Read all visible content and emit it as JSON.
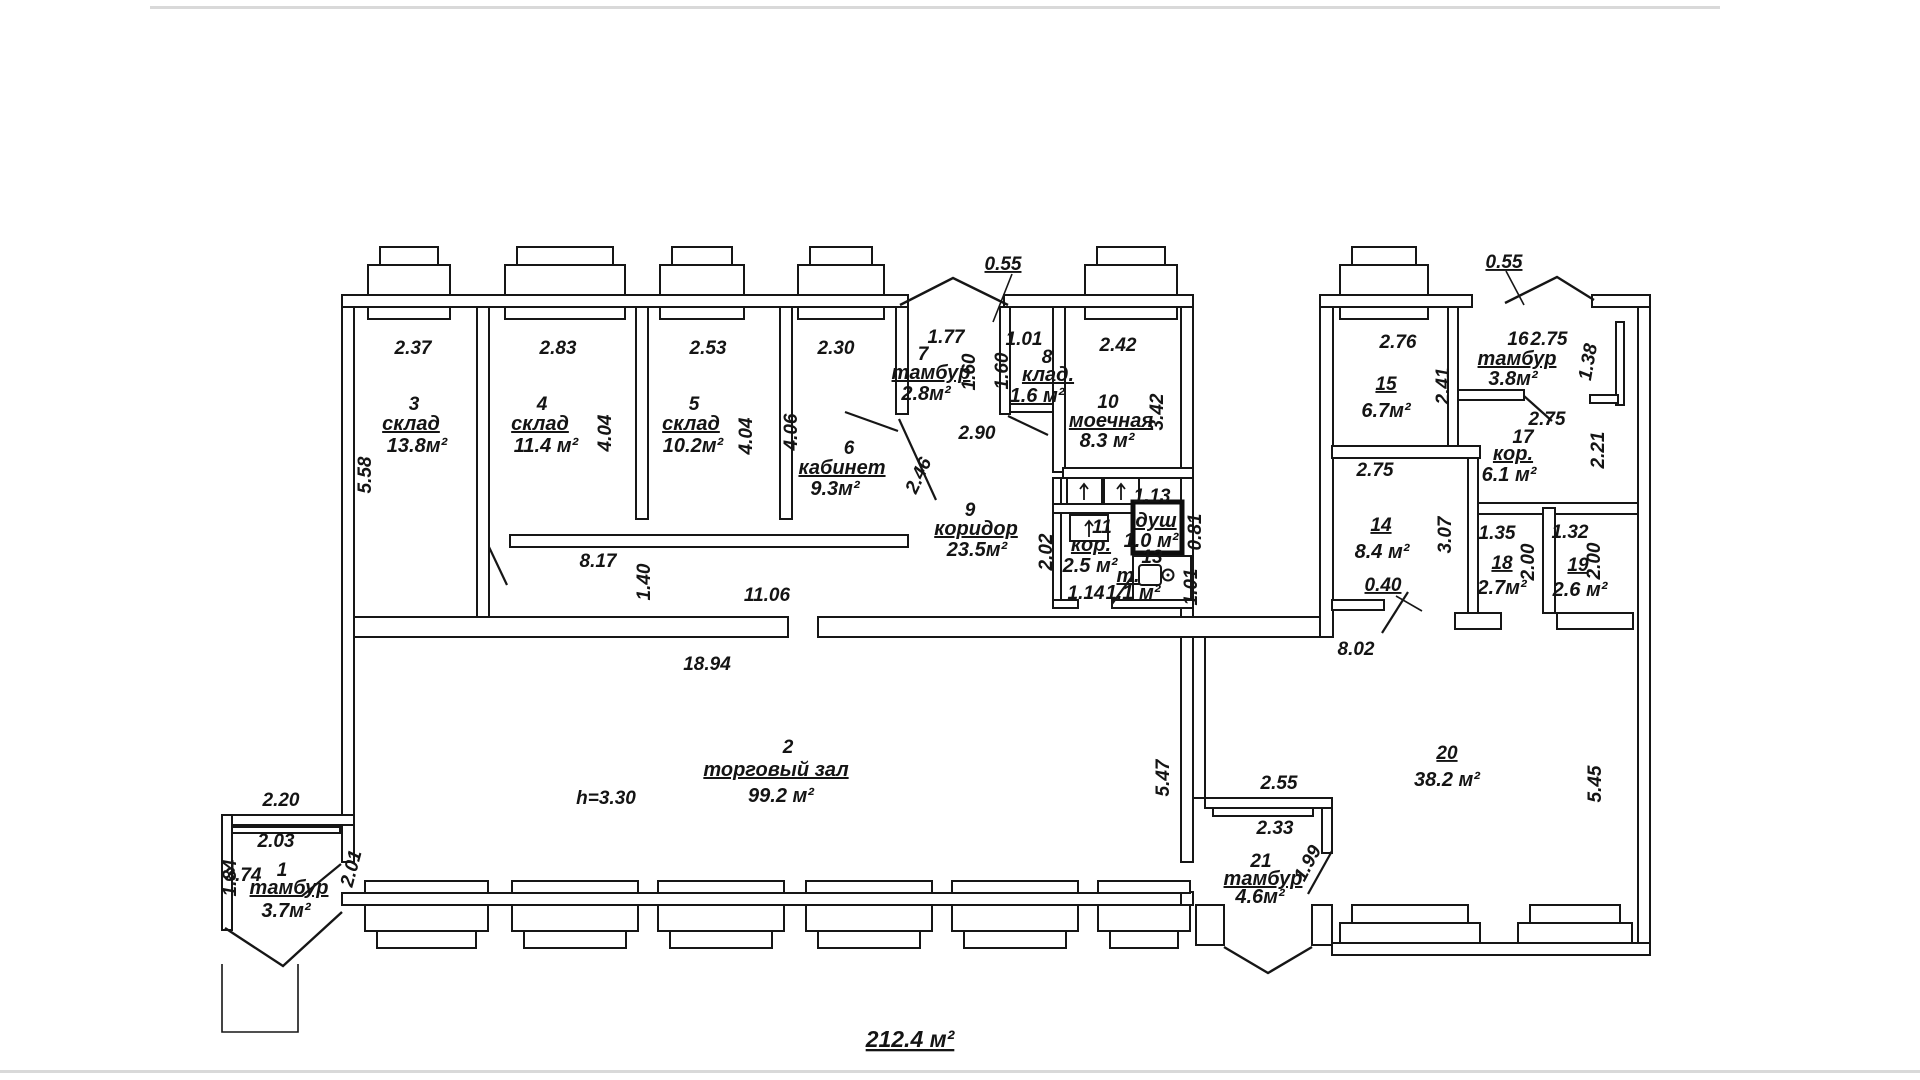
{
  "total_area_label": "212.4 м²",
  "rooms": [
    {
      "num": "1",
      "name": "тамбур",
      "area": "3.7м²"
    },
    {
      "num": "2",
      "name": "торговый зал",
      "area": "99.2 м²"
    },
    {
      "num": "3",
      "name": "склад",
      "area": "13.8м²"
    },
    {
      "num": "4",
      "name": "склад",
      "area": "11.4 м²"
    },
    {
      "num": "5",
      "name": "склад",
      "area": "10.2м²"
    },
    {
      "num": "6",
      "name": "кабинет",
      "area": "9.3м²"
    },
    {
      "num": "7",
      "name": "тамбур",
      "area": "2.8м²"
    },
    {
      "num": "8",
      "name": "клад.",
      "area": "1.6 м²"
    },
    {
      "num": "9",
      "name": "коридор",
      "area": "23.5м²"
    },
    {
      "num": "10",
      "name": "моечная",
      "area": "8.3 м²"
    },
    {
      "num": "11",
      "name": "кор.",
      "area": "2.5 м²"
    },
    {
      "num": "",
      "name": "душ",
      "area": "1.0 м²"
    },
    {
      "num": "13",
      "name": "т.",
      "area": "1.1 м²"
    },
    {
      "num": "14",
      "name": "",
      "area": "8.4 м²"
    },
    {
      "num": "15",
      "name": "",
      "area": "6.7м²"
    },
    {
      "num": "16",
      "name": "тамбур",
      "area": "3.8м²"
    },
    {
      "num": "17",
      "name": "кор.",
      "area": "6.1 м²"
    },
    {
      "num": "18",
      "name": "",
      "area": "2.7м²"
    },
    {
      "num": "19",
      "name": "",
      "area": "2.6 м²"
    },
    {
      "num": "20",
      "name": "",
      "area": "38.2 м²"
    },
    {
      "num": "21",
      "name": "тамбур",
      "area": "4.6м²"
    }
  ],
  "dims": {
    "room3_w": "2.37",
    "room3_h": "5.58",
    "room4_w": "2.83",
    "room4_h": "4.04",
    "room5_w": "2.53",
    "room5_h": "4.04",
    "room6_w": "2.30",
    "room6_h": "4.06",
    "room7_w": "1.77",
    "room7_h": "1.60",
    "room8_w": "1.01",
    "room8_h": "1.60",
    "room10_w": "2.42",
    "room10_h": "3.42",
    "porch_left": "0.55",
    "porch_right": "0.55",
    "corridor_w": "2.90",
    "door_246": "2.46",
    "room11_h": "2.02",
    "room11_w": "1.14",
    "shower_w": "1.13",
    "wall_081": "0.81",
    "wall_101": "1.01",
    "sill_817": "8.17",
    "strip_h": "1.40",
    "hall_top": "11.06",
    "hall_w": "18.94",
    "hall_h": "5.47",
    "height_note": "h=3.30",
    "t1_w": "2.20",
    "t1_iw": "2.03",
    "t1_h": "2.01",
    "t1_d": "1.84",
    "t1_x": "3.74",
    "room15_w": "2.76",
    "room15_h": "2.41",
    "room16_w": "2.75",
    "niche_h": "1.38",
    "niche_d": "2.21",
    "room17_w": "2.75",
    "room14_w": "2.75",
    "door_040": "0.40",
    "room18_w": "1.35",
    "room18_h": "2.00",
    "room18_l": "3.07",
    "room19_w": "1.32",
    "room19_h": "2.00",
    "room20_w": "8.02",
    "room20_h": "5.45",
    "t21_w": "2.55",
    "t21_iw": "2.33",
    "t21_d": "1.99"
  },
  "labels": [
    {
      "b": "rooms.0.num",
      "x": 282,
      "y": 876,
      "c": "num"
    },
    {
      "b": "rooms.0.name",
      "x": 289,
      "y": 894,
      "c": "name u"
    },
    {
      "b": "rooms.0.area",
      "x": 286,
      "y": 917,
      "c": "area"
    },
    {
      "b": "rooms.1.num",
      "x": 788,
      "y": 753,
      "c": "num"
    },
    {
      "b": "rooms.1.name",
      "x": 776,
      "y": 776,
      "c": "name u"
    },
    {
      "b": "rooms.1.area",
      "x": 781,
      "y": 802,
      "c": "area"
    },
    {
      "b": "rooms.2.num",
      "x": 414,
      "y": 410,
      "c": "num"
    },
    {
      "b": "rooms.2.name",
      "x": 411,
      "y": 430,
      "c": "name u"
    },
    {
      "b": "rooms.2.area",
      "x": 417,
      "y": 452,
      "c": "area"
    },
    {
      "b": "rooms.3.num",
      "x": 542,
      "y": 410,
      "c": "num"
    },
    {
      "b": "rooms.3.name",
      "x": 540,
      "y": 430,
      "c": "name u"
    },
    {
      "b": "rooms.3.area",
      "x": 546,
      "y": 452,
      "c": "area"
    },
    {
      "b": "rooms.4.num",
      "x": 694,
      "y": 410,
      "c": "num"
    },
    {
      "b": "rooms.4.name",
      "x": 691,
      "y": 430,
      "c": "name u"
    },
    {
      "b": "rooms.4.area",
      "x": 693,
      "y": 452,
      "c": "area"
    },
    {
      "b": "rooms.5.num",
      "x": 849,
      "y": 454,
      "c": "num"
    },
    {
      "b": "rooms.5.name",
      "x": 842,
      "y": 474,
      "c": "name u"
    },
    {
      "b": "rooms.5.area",
      "x": 835,
      "y": 495,
      "c": "area"
    },
    {
      "b": "rooms.6.num",
      "x": 923,
      "y": 360,
      "c": "num"
    },
    {
      "b": "rooms.6.name",
      "x": 931,
      "y": 379,
      "c": "name u"
    },
    {
      "b": "rooms.6.area",
      "x": 926,
      "y": 400,
      "c": "area"
    },
    {
      "b": "rooms.7.num",
      "x": 1047,
      "y": 363,
      "c": "num"
    },
    {
      "b": "rooms.7.name",
      "x": 1048,
      "y": 381,
      "c": "name u"
    },
    {
      "b": "rooms.7.area",
      "x": 1037,
      "y": 402,
      "c": "area"
    },
    {
      "b": "rooms.8.num",
      "x": 970,
      "y": 516,
      "c": "num"
    },
    {
      "b": "rooms.8.name",
      "x": 976,
      "y": 535,
      "c": "name u"
    },
    {
      "b": "rooms.8.area",
      "x": 977,
      "y": 556,
      "c": "area"
    },
    {
      "b": "rooms.9.num",
      "x": 1108,
      "y": 408,
      "c": "num"
    },
    {
      "b": "rooms.9.name",
      "x": 1111,
      "y": 427,
      "c": "name u"
    },
    {
      "b": "rooms.9.area",
      "x": 1107,
      "y": 447,
      "c": "area"
    },
    {
      "b": "rooms.10.num",
      "x": 1102,
      "y": 533,
      "c": "num"
    },
    {
      "b": "rooms.10.name",
      "x": 1091,
      "y": 551,
      "c": "name u"
    },
    {
      "b": "rooms.10.area",
      "x": 1090,
      "y": 572,
      "c": "area"
    },
    {
      "b": "rooms.11.name",
      "x": 1156,
      "y": 527,
      "c": "name u"
    },
    {
      "b": "rooms.11.area",
      "x": 1151,
      "y": 547,
      "c": "area"
    },
    {
      "b": "rooms.12.num",
      "x": 1152,
      "y": 563,
      "c": "num"
    },
    {
      "b": "rooms.12.name",
      "x": 1128,
      "y": 582,
      "c": "name u"
    },
    {
      "b": "rooms.12.area",
      "x": 1133,
      "y": 599,
      "c": "area"
    },
    {
      "b": "rooms.13.num",
      "x": 1381,
      "y": 531,
      "c": "num u"
    },
    {
      "b": "rooms.13.area",
      "x": 1382,
      "y": 558,
      "c": "area"
    },
    {
      "b": "rooms.14.num",
      "x": 1386,
      "y": 390,
      "c": "num u"
    },
    {
      "b": "rooms.14.area",
      "x": 1386,
      "y": 417,
      "c": "area"
    },
    {
      "b": "rooms.15.num",
      "x": 1518,
      "y": 345,
      "c": "num"
    },
    {
      "b": "rooms.15.name",
      "x": 1517,
      "y": 365,
      "c": "name u"
    },
    {
      "b": "rooms.15.area",
      "x": 1513,
      "y": 385,
      "c": "area"
    },
    {
      "b": "rooms.16.num",
      "x": 1523,
      "y": 443,
      "c": "num"
    },
    {
      "b": "rooms.16.name",
      "x": 1513,
      "y": 460,
      "c": "name u"
    },
    {
      "b": "rooms.16.area",
      "x": 1509,
      "y": 481,
      "c": "area"
    },
    {
      "b": "rooms.17.num",
      "x": 1502,
      "y": 569,
      "c": "num u"
    },
    {
      "b": "rooms.17.area",
      "x": 1502,
      "y": 594,
      "c": "area"
    },
    {
      "b": "rooms.18.num",
      "x": 1578,
      "y": 571,
      "c": "num u"
    },
    {
      "b": "rooms.18.area",
      "x": 1580,
      "y": 596,
      "c": "area"
    },
    {
      "b": "rooms.19.num",
      "x": 1447,
      "y": 759,
      "c": "num u"
    },
    {
      "b": "rooms.19.area",
      "x": 1447,
      "y": 786,
      "c": "area"
    },
    {
      "b": "rooms.20.num",
      "x": 1261,
      "y": 867,
      "c": "num"
    },
    {
      "b": "rooms.20.name",
      "x": 1263,
      "y": 885,
      "c": "name u"
    },
    {
      "b": "rooms.20.area",
      "x": 1260,
      "y": 903,
      "c": "area"
    },
    {
      "b": "dims.room3_w",
      "x": 413,
      "y": 354
    },
    {
      "b": "dims.room3_h",
      "x": 371,
      "y": 475,
      "r": -90
    },
    {
      "b": "dims.room4_w",
      "x": 558,
      "y": 354
    },
    {
      "b": "dims.room4_h",
      "x": 611,
      "y": 433,
      "r": -90
    },
    {
      "b": "dims.room5_w",
      "x": 708,
      "y": 354
    },
    {
      "b": "dims.room5_h",
      "x": 752,
      "y": 436,
      "r": -90
    },
    {
      "b": "dims.room6_w",
      "x": 836,
      "y": 354
    },
    {
      "b": "dims.room6_h",
      "x": 797,
      "y": 432,
      "r": -90
    },
    {
      "b": "dims.room7_w",
      "x": 946,
      "y": 343
    },
    {
      "b": "dims.room7_h",
      "x": 975,
      "y": 372,
      "r": -90
    },
    {
      "b": "dims.room8_w",
      "x": 1024,
      "y": 345
    },
    {
      "b": "dims.room8_h",
      "x": 1008,
      "y": 371,
      "r": -90
    },
    {
      "b": "dims.room10_w",
      "x": 1118,
      "y": 351
    },
    {
      "b": "dims.room10_h",
      "x": 1163,
      "y": 412,
      "r": -90
    },
    {
      "b": "dims.porch_left",
      "x": 1003,
      "y": 270,
      "c": "dim u"
    },
    {
      "b": "dims.porch_right",
      "x": 1504,
      "y": 268,
      "c": "dim u"
    },
    {
      "b": "dims.corridor_w",
      "x": 977,
      "y": 439
    },
    {
      "b": "dims.door_246",
      "x": 924,
      "y": 478,
      "r": -65
    },
    {
      "b": "dims.room11_h",
      "x": 1052,
      "y": 552,
      "r": -90
    },
    {
      "b": "dims.room11_w",
      "x": 1086,
      "y": 599
    },
    {
      "b": "dims.shower_w",
      "x": 1152,
      "y": 502
    },
    {
      "b": "dims.wall_081",
      "x": 1201,
      "y": 532,
      "r": -90
    },
    {
      "b": "dims.wall_101",
      "x": 1197,
      "y": 587,
      "r": -90
    },
    {
      "b": "dims.sill_817",
      "x": 598,
      "y": 567
    },
    {
      "b": "dims.strip_h",
      "x": 650,
      "y": 582,
      "r": -90
    },
    {
      "b": "dims.hall_top",
      "x": 767,
      "y": 601
    },
    {
      "b": "dims.hall_w",
      "x": 707,
      "y": 670
    },
    {
      "b": "dims.hall_h",
      "x": 1169,
      "y": 778,
      "r": -90
    },
    {
      "b": "dims.height_note",
      "x": 606,
      "y": 804
    },
    {
      "b": "dims.t1_w",
      "x": 281,
      "y": 806
    },
    {
      "b": "dims.t1_iw",
      "x": 276,
      "y": 847
    },
    {
      "b": "dims.t1_h",
      "x": 357,
      "y": 870,
      "r": -75
    },
    {
      "b": "dims.t1_d",
      "x": 236,
      "y": 878,
      "r": -90
    },
    {
      "b": "dims.t1_x",
      "x": 243,
      "y": 881
    },
    {
      "b": "dims.room15_w",
      "x": 1398,
      "y": 348
    },
    {
      "b": "dims.room15_h",
      "x": 1449,
      "y": 386,
      "r": -90
    },
    {
      "b": "dims.room16_w",
      "x": 1549,
      "y": 345
    },
    {
      "b": "dims.niche_h",
      "x": 1594,
      "y": 363,
      "r": -80
    },
    {
      "b": "dims.niche_d",
      "x": 1604,
      "y": 450,
      "r": -90
    },
    {
      "b": "dims.room17_w",
      "x": 1547,
      "y": 425
    },
    {
      "b": "dims.room14_w",
      "x": 1375,
      "y": 476
    },
    {
      "b": "dims.door_040",
      "x": 1383,
      "y": 591,
      "c": "dim u"
    },
    {
      "b": "dims.room18_w",
      "x": 1497,
      "y": 539
    },
    {
      "b": "dims.room18_h",
      "x": 1534,
      "y": 562,
      "r": -90
    },
    {
      "b": "dims.room18_l",
      "x": 1451,
      "y": 535,
      "r": -90
    },
    {
      "b": "dims.room19_w",
      "x": 1570,
      "y": 538
    },
    {
      "b": "dims.room19_h",
      "x": 1600,
      "y": 561,
      "r": -90
    },
    {
      "b": "dims.room20_w",
      "x": 1356,
      "y": 655
    },
    {
      "b": "dims.room20_h",
      "x": 1601,
      "y": 784,
      "r": -90
    },
    {
      "b": "dims.t21_w",
      "x": 1279,
      "y": 789
    },
    {
      "b": "dims.t21_iw",
      "x": 1275,
      "y": 834
    },
    {
      "b": "dims.t21_d",
      "x": 1313,
      "y": 866,
      "r": -62
    },
    {
      "b": "total_area_label",
      "x": 910,
      "y": 1047,
      "c": "total u"
    }
  ]
}
